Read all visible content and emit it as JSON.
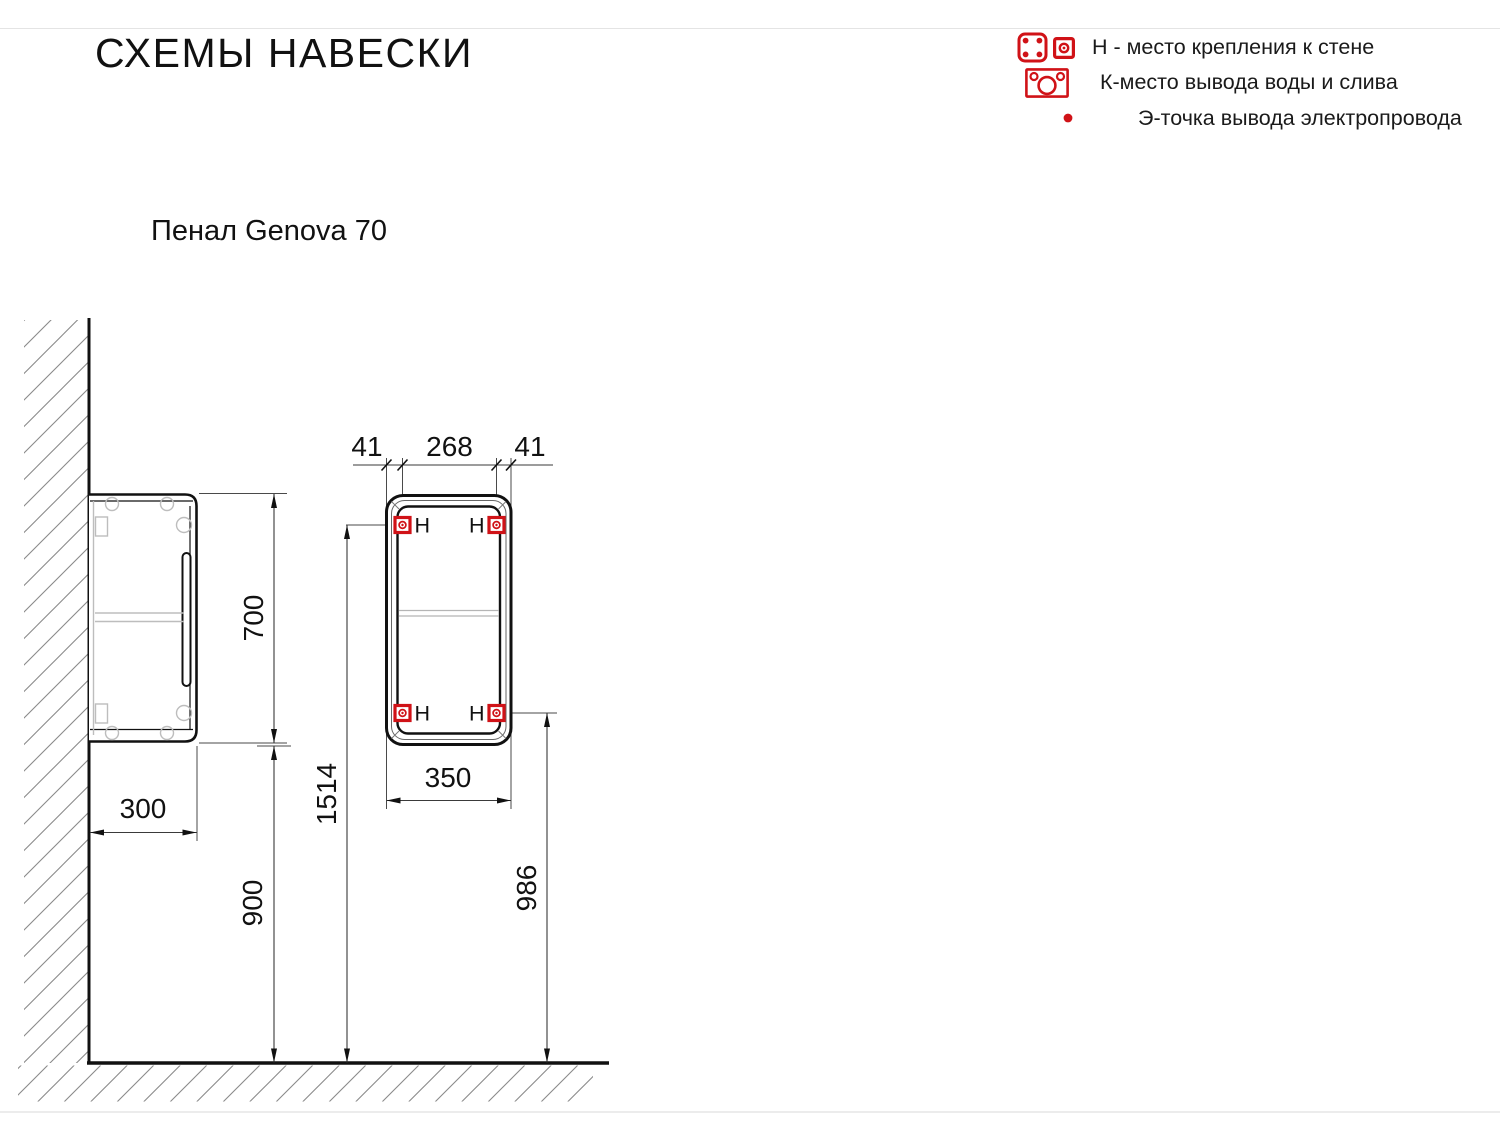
{
  "page": {
    "title": "СХЕМЫ НАВЕСКИ",
    "subtitle": "Пенал Genova 70"
  },
  "legend": {
    "items": [
      {
        "icon": "wall-bracket-icons",
        "label": "Н - место крепления к стене"
      },
      {
        "icon": "water-drain-outlet-icon",
        "label": "К-место вывода воды и слива"
      },
      {
        "icon": "red-dot-icon",
        "label": "Э-точка вывода электропровода"
      }
    ]
  },
  "colors": {
    "accent_red": "#d01217",
    "line_black": "#111111",
    "line_gray": "#4a4a4a",
    "detail_gray": "#bdbdbd"
  },
  "diagram": {
    "fastener_label": "Н",
    "dims": {
      "height": "700",
      "depth": "300",
      "bottom_clearance": "900",
      "top_offset_left": "41",
      "fastener_span": "268",
      "top_offset_right": "41",
      "width": "350",
      "top_fastener_height": "1514",
      "bottom_fastener_height": "986"
    }
  }
}
